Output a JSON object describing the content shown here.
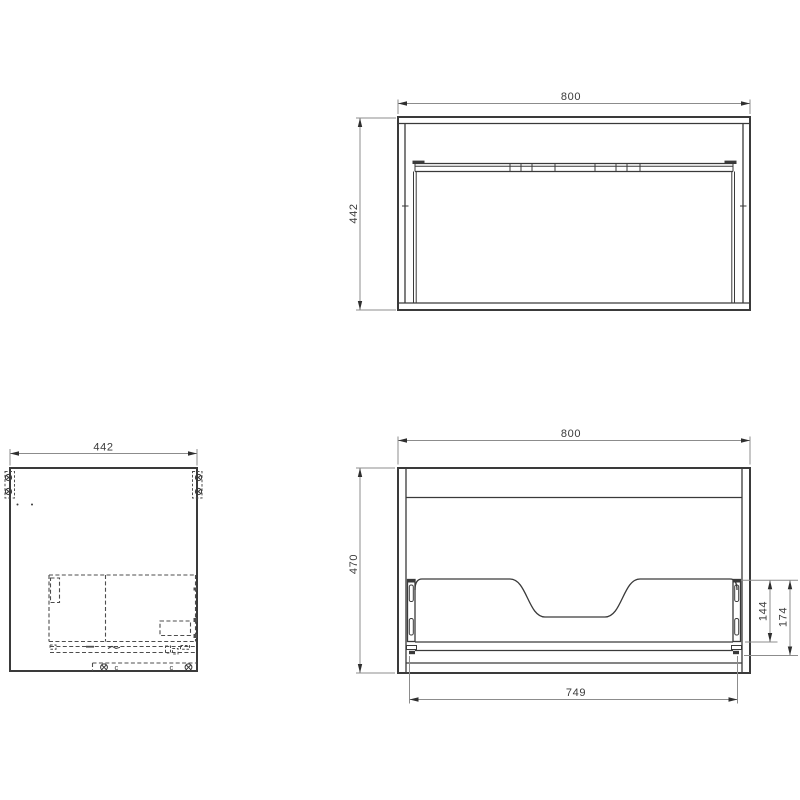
{
  "drawing": {
    "background_color": "#ffffff",
    "line_color": "#3a3a3a",
    "dimension_line_color": "#8c8c8c",
    "views": {
      "top": {
        "dim_width": "800",
        "dim_depth": "442"
      },
      "side": {
        "dim_depth": "442",
        "clip_mark": "c"
      },
      "rear": {
        "dim_width": "800",
        "dim_height": "470",
        "dim_back_panel_height": "144",
        "dim_slide_height": "174",
        "dim_inner_width": "749"
      }
    }
  }
}
